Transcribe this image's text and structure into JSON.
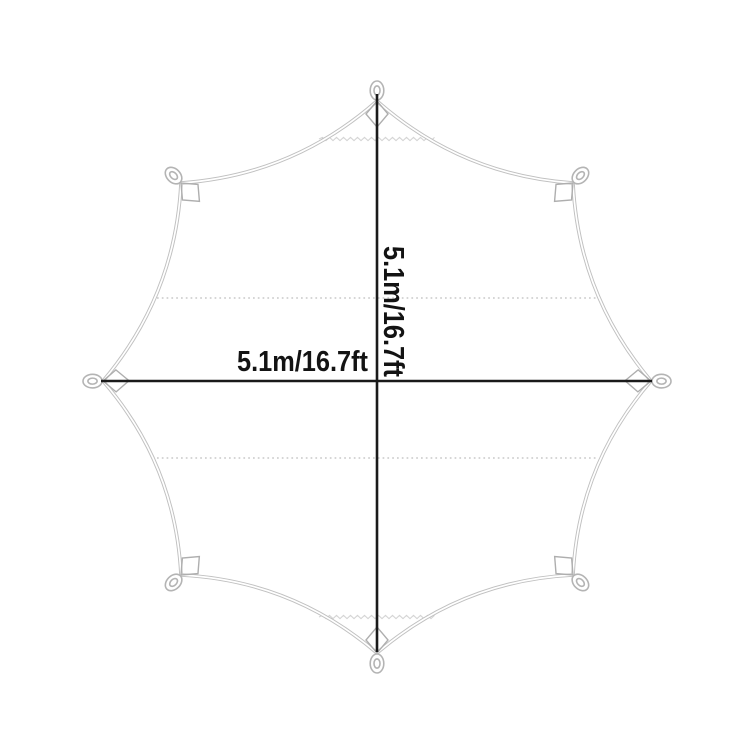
{
  "diagram": {
    "title": "octagonal tarp dimension diagram",
    "width_label": "5.1m/16.7ft",
    "height_label": "5.1m/16.7ft",
    "corner_count": 8,
    "colors": {
      "background": "#ffffff",
      "outline": "#c0c0c0",
      "outline_inner": "#ffffff",
      "patch": "#aeaeae",
      "loop": "#b4b4b4",
      "seam_dotted": "#c8c8c8",
      "stitch_zigzag": "#d4d4d4",
      "dimension_line": "#1a1a1a",
      "text": "#131313"
    }
  }
}
